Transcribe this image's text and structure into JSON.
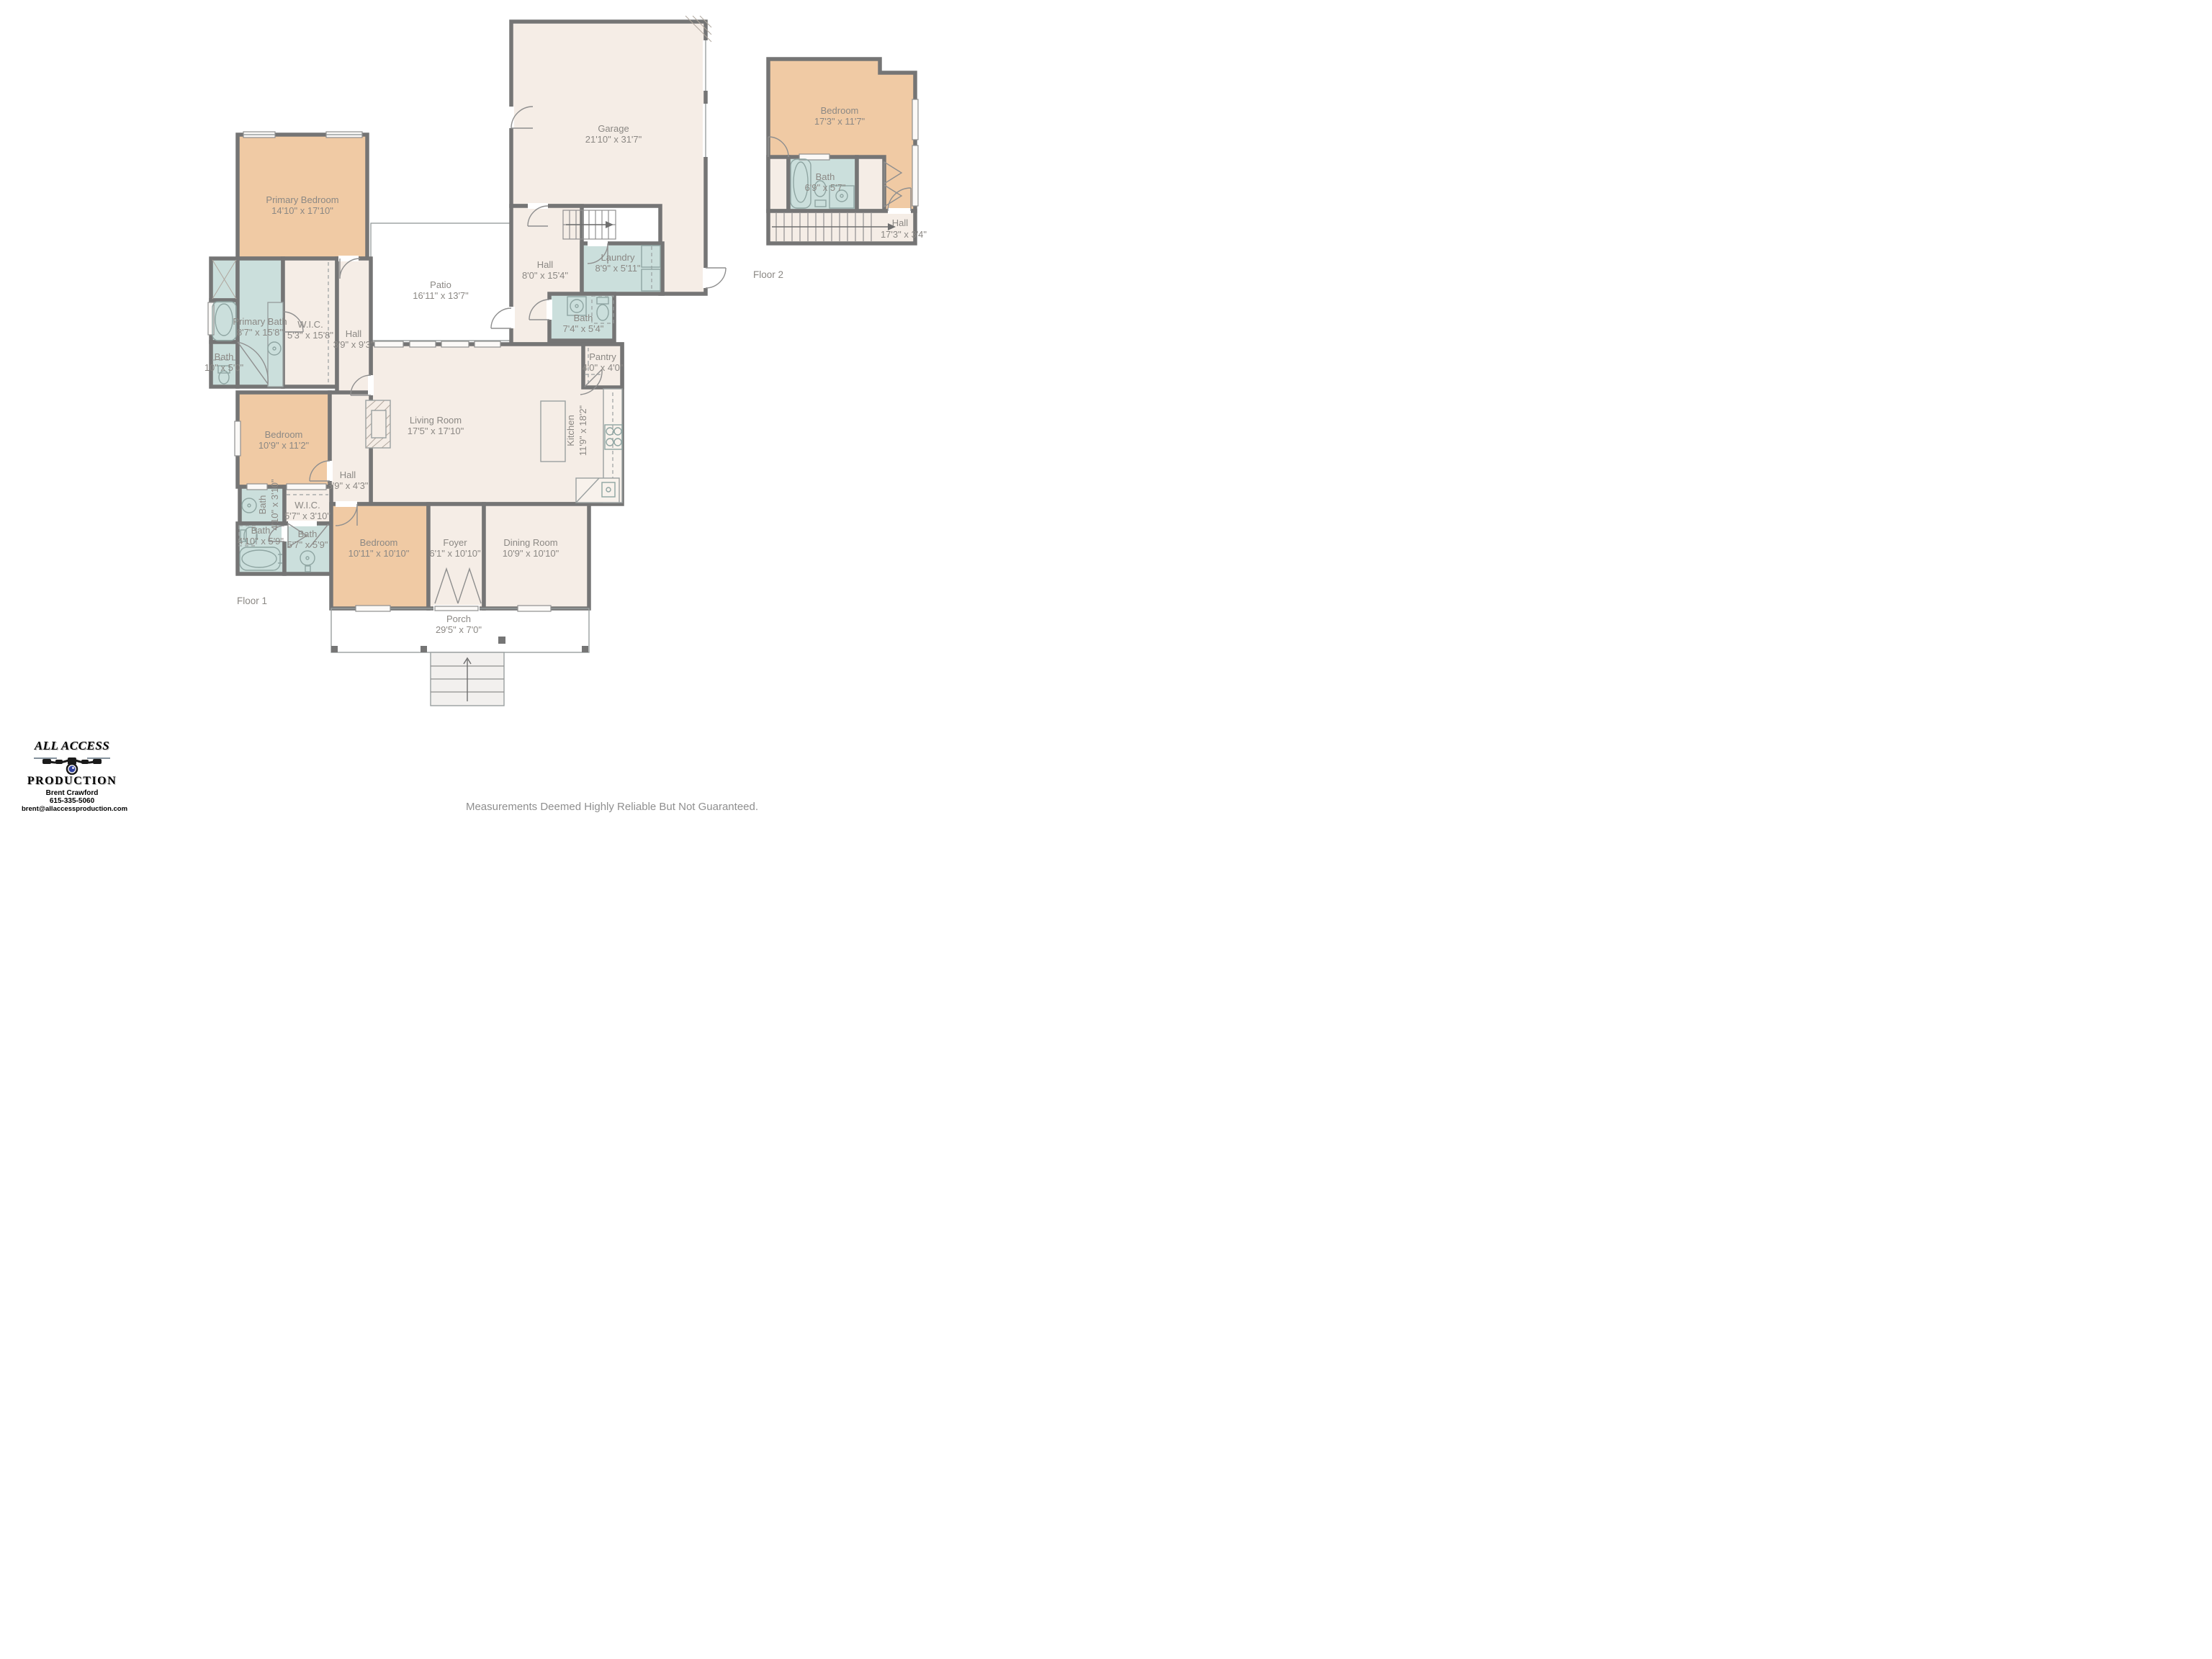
{
  "floor1": {
    "label": "Floor 1",
    "rooms": {
      "primary_bedroom": {
        "name": "Primary Bedroom",
        "dims": "14'10\" x 17'10\""
      },
      "primary_bath": {
        "name": "Primary Bath",
        "dims": "8'7\" x 15'8\""
      },
      "bath_small": {
        "name": "Bath",
        "dims": "10\" x 5'0\""
      },
      "wic_main": {
        "name": "W.I.C.",
        "dims": "5'3\" x 15'8\""
      },
      "hall_west": {
        "name": "Hall",
        "dims": "3'9\" x 9'3\""
      },
      "patio": {
        "name": "Patio",
        "dims": "16'11\" x 13'7\""
      },
      "garage": {
        "name": "Garage",
        "dims": "21'10\" x 31'7\""
      },
      "hall_center": {
        "name": "Hall",
        "dims": "8'0\" x 15'4\""
      },
      "laundry": {
        "name": "Laundry",
        "dims": "8'9\" x 5'11\""
      },
      "bath_center": {
        "name": "Bath",
        "dims": "7'4\" x 5'4\""
      },
      "pantry": {
        "name": "Pantry",
        "dims": "4'0\" x 4'0\""
      },
      "living_room": {
        "name": "Living Room",
        "dims": "17'5\" x 17'10\""
      },
      "kitchen": {
        "name": "Kitchen",
        "dims": "11'9\" x 18'2\""
      },
      "bedroom_mid": {
        "name": "Bedroom",
        "dims": "10'9\" x 11'2\""
      },
      "hall_small": {
        "name": "Hall",
        "dims": "3'9\" x 4'3\""
      },
      "bath_vert": {
        "name": "Bath",
        "dims": "4'10\" x 3'10\""
      },
      "wic_small": {
        "name": "W.I.C.",
        "dims": "5'7\" x 3'10\""
      },
      "bath_sw": {
        "name": "Bath",
        "dims": "4'10\" x 5'9\""
      },
      "bath_s": {
        "name": "Bath",
        "dims": "5'7\" x 5'9\""
      },
      "bedroom_s": {
        "name": "Bedroom",
        "dims": "10'11\" x 10'10\""
      },
      "foyer": {
        "name": "Foyer",
        "dims": "6'1\" x 10'10\""
      },
      "dining": {
        "name": "Dining Room",
        "dims": "10'9\" x 10'10\""
      },
      "porch": {
        "name": "Porch",
        "dims": "29'5\" x 7'0\""
      }
    }
  },
  "floor2": {
    "label": "Floor 2",
    "rooms": {
      "bedroom": {
        "name": "Bedroom",
        "dims": "17'3\" x 11'7\""
      },
      "bath": {
        "name": "Bath",
        "dims": "6'9\" x 5'7\""
      },
      "hall": {
        "name": "Hall",
        "dims": "17'3\" x 3'4\""
      }
    }
  },
  "branding": {
    "line1": "ALL ACCESS",
    "line2": "PRODUCTION",
    "contact_name": "Brent Crawford",
    "phone": "615-335-5060",
    "email": "brent@allaccessproduction.com"
  },
  "footer": {
    "disclaimer": "Measurements Deemed Highly Reliable But Not Guaranteed."
  },
  "colors": {
    "wall": "#757575",
    "bedroom_fill": "#F0CAA4",
    "bath_fill": "#CBDFDC",
    "room_fill": "#F5EDE6",
    "outdoor_fill": "#EAEAEA",
    "label_text": "#8B8884"
  }
}
